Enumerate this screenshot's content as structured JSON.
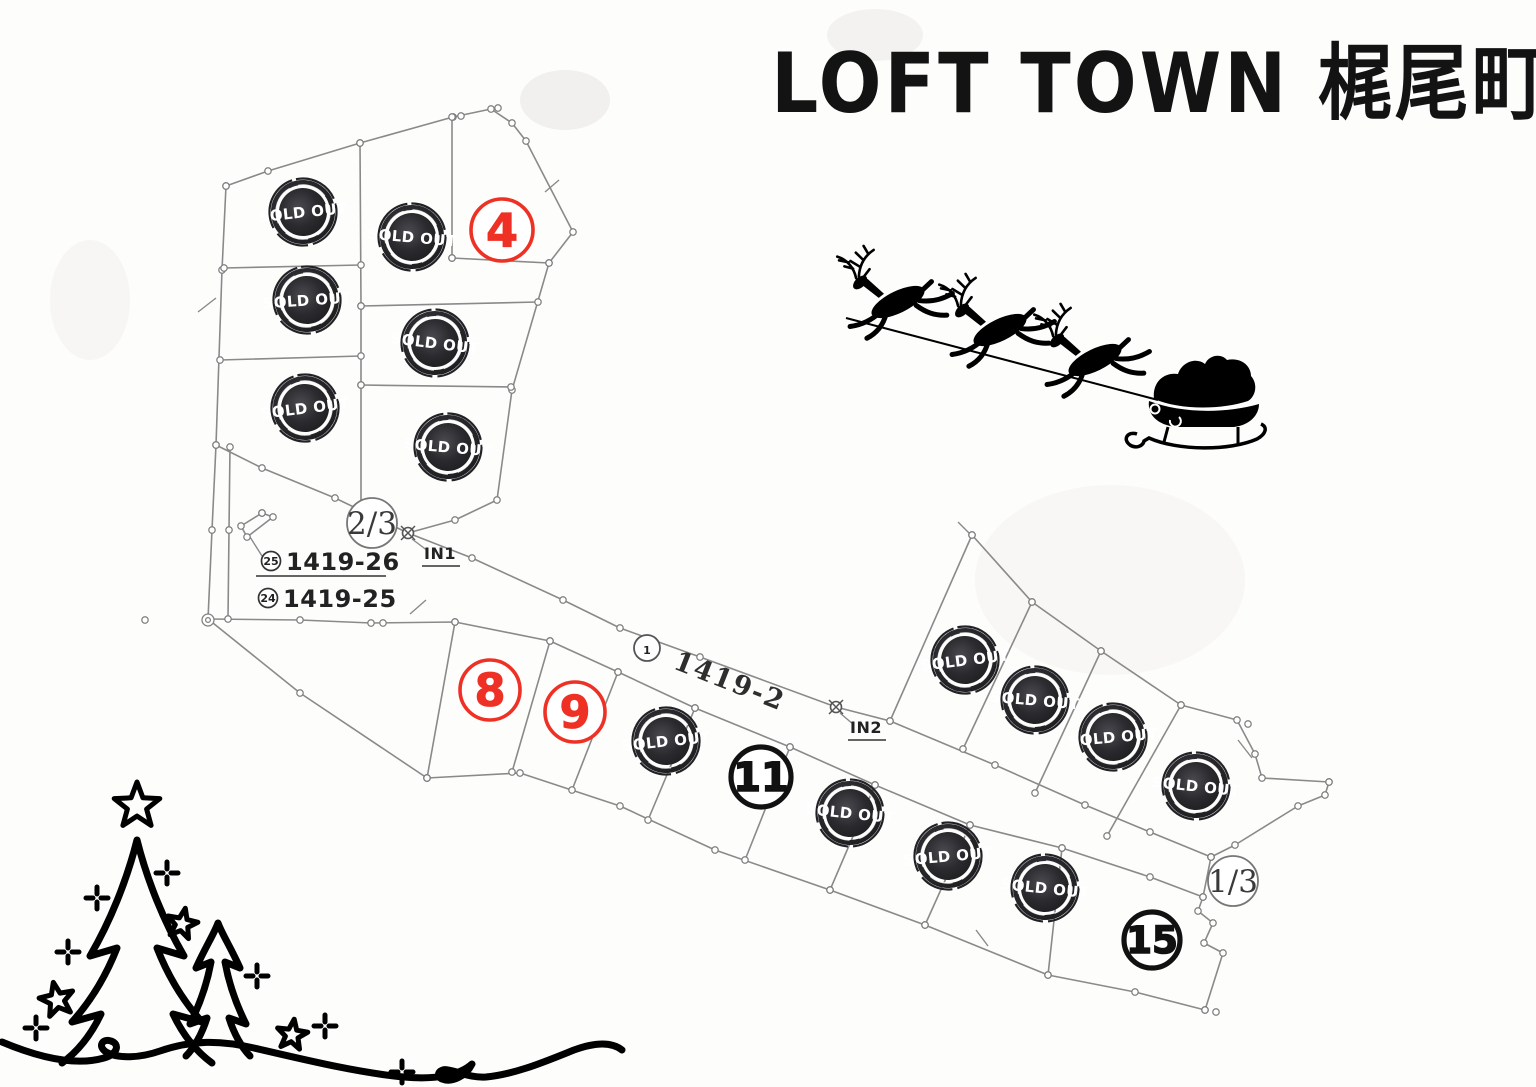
{
  "title": "LOFT TOWN 梶尾町",
  "colors": {
    "accent_red": "#ee3124",
    "line_gray": "#8a8a8a",
    "stamp_dark": "#202023",
    "text_dark": "#1c1c1c"
  },
  "map": {
    "sold_stamp_label": "SOLD OUT",
    "available_lots": [
      {
        "number": "4",
        "color": "red",
        "x": 502,
        "y": 230,
        "r": 31
      },
      {
        "number": "8",
        "color": "red",
        "x": 490,
        "y": 690,
        "r": 30
      },
      {
        "number": "9",
        "color": "red",
        "x": 575,
        "y": 712,
        "r": 30
      },
      {
        "number": "11",
        "color": "black",
        "x": 761,
        "y": 777,
        "r": 30
      },
      {
        "number": "15",
        "color": "black",
        "x": 1152,
        "y": 940,
        "r": 28
      }
    ],
    "sold_lots": [
      {
        "x": 303,
        "y": 212,
        "rot": -6
      },
      {
        "x": 412,
        "y": 237,
        "rot": 5
      },
      {
        "x": 307,
        "y": 300,
        "rot": -4
      },
      {
        "x": 435,
        "y": 343,
        "rot": 7
      },
      {
        "x": 305,
        "y": 408,
        "rot": -7
      },
      {
        "x": 448,
        "y": 447,
        "rot": 5
      },
      {
        "x": 666,
        "y": 741,
        "rot": -6
      },
      {
        "x": 850,
        "y": 813,
        "rot": 6
      },
      {
        "x": 948,
        "y": 856,
        "rot": -5
      },
      {
        "x": 1045,
        "y": 888,
        "rot": 6
      },
      {
        "x": 965,
        "y": 660,
        "rot": -7
      },
      {
        "x": 1035,
        "y": 700,
        "rot": 5
      },
      {
        "x": 1113,
        "y": 737,
        "rot": -5
      },
      {
        "x": 1196,
        "y": 786,
        "rot": 6
      }
    ],
    "junctions": [
      {
        "label": "2/3",
        "x": 372,
        "y": 523,
        "r": 25
      },
      {
        "label": "1/3",
        "x": 1233,
        "y": 881,
        "r": 25
      }
    ],
    "road_label": {
      "circled_number": "1",
      "text": "1419-2",
      "cx": 647,
      "cy": 648,
      "tx": 672,
      "ty": 668,
      "angle": 21.5
    },
    "entrances": [
      {
        "label": "IN1",
        "cx": 408,
        "cy": 533,
        "tx": 440,
        "ty": 559
      },
      {
        "label": "IN2",
        "cx": 836,
        "cy": 707,
        "tx": 866,
        "ty": 733
      }
    ],
    "parcel_refs": [
      {
        "circled_number": "25",
        "text": "1419-26",
        "cx": 271,
        "cy": 561,
        "tx": 286,
        "ty": 570,
        "underline": true
      },
      {
        "circled_number": "24",
        "text": "1419-25",
        "cx": 268,
        "cy": 598,
        "tx": 283,
        "ty": 607,
        "underline": false
      }
    ]
  },
  "decor": {
    "sleigh_label": "santa sleigh pulled by three reindeer (silhouette)",
    "trees_label": "christmas trees with stars (line art)"
  }
}
